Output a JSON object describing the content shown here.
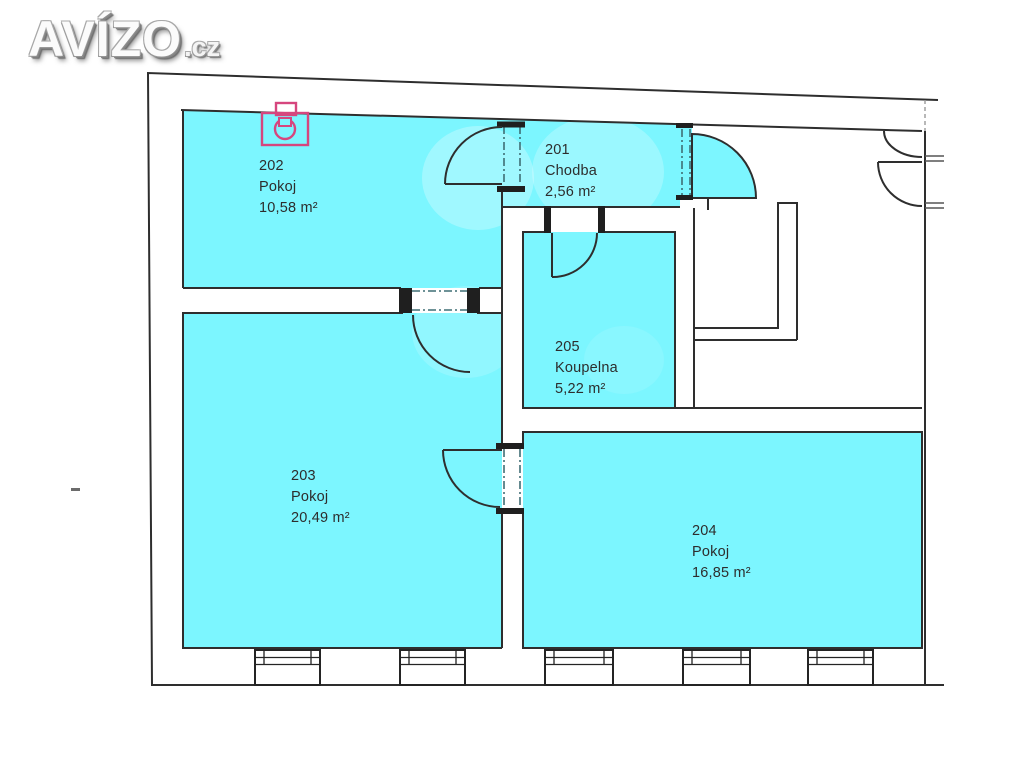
{
  "logo": {
    "brand": "AVÍZO",
    "tld": ".cz"
  },
  "plan": {
    "title": "Floor plan",
    "rooms": [
      {
        "number": "201",
        "name": "Chodba",
        "area": "2,56 m²"
      },
      {
        "number": "202",
        "name": "Pokoj",
        "area": "10,58 m²"
      },
      {
        "number": "203",
        "name": "Pokoj",
        "area": "20,49 m²"
      },
      {
        "number": "204",
        "name": "Pokoj",
        "area": "16,85 m²"
      },
      {
        "number": "205",
        "name": "Koupelna",
        "area": "5,22 m²"
      }
    ],
    "icons": {
      "fixture": "boiler-icon"
    },
    "colors": {
      "room_fill": "#7cf6ff",
      "wall": "#2e2e2e",
      "dash": "#3f6e75",
      "fixture": "#d6467e"
    }
  }
}
